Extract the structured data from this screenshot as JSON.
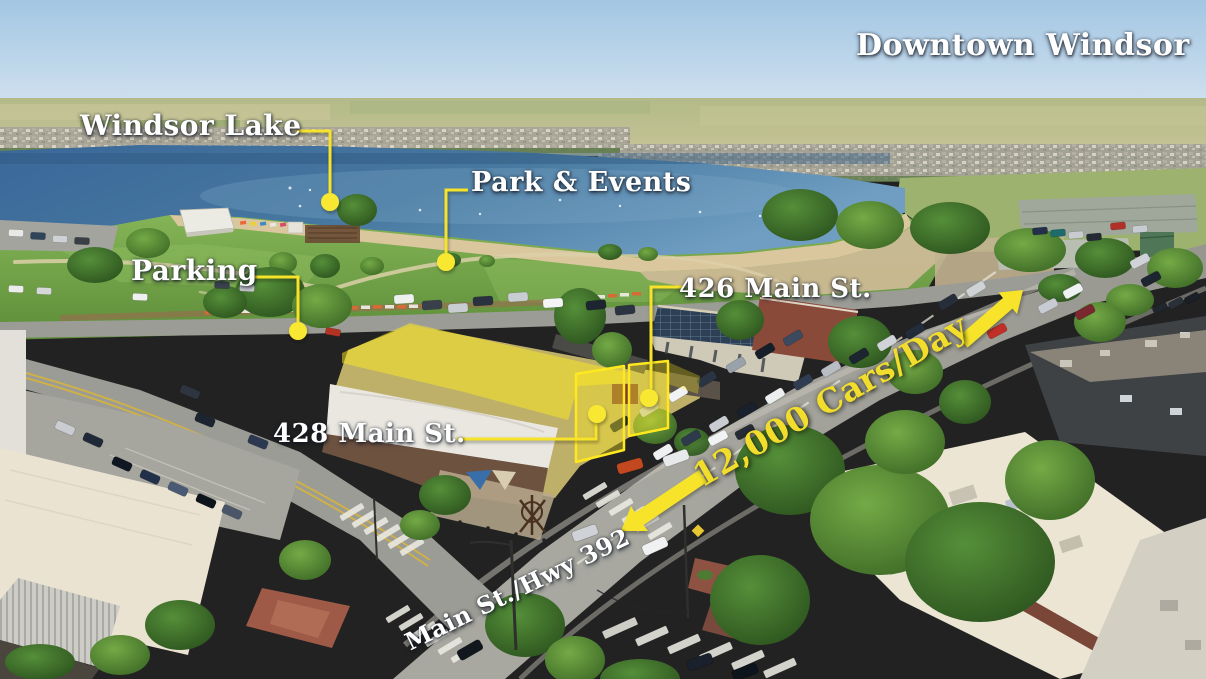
{
  "image": {
    "type": "annotated-aerial-photograph",
    "subject": "Downtown Windsor commercial property with Windsor Lake and Main Street"
  },
  "labels": {
    "downtown": "Downtown Windsor",
    "windsor_lake": "Windsor Lake",
    "park_events": "Park & Events",
    "parking": "Parking",
    "main_426": "426 Main St.",
    "main_428": "428 Main St.",
    "traffic": "12,000 Cars/Day",
    "highway": "Main St./Hwy 392"
  },
  "colors": {
    "annotation_yellow": "#f6e32b",
    "marker_dot_yellow": "#f8e832",
    "label_text": "#ffffff",
    "traffic_text": "#f2dd2d",
    "building_highlight_fill": "#fce921",
    "building_highlight_outline": "#ffe81f",
    "lake_blue": "#3e6e9e",
    "park_green": "#6da344"
  },
  "markers": [
    {
      "name": "windsor-lake-marker",
      "label": "Windsor Lake"
    },
    {
      "name": "park-events-marker",
      "label": "Park & Events"
    },
    {
      "name": "parking-marker",
      "label": "Parking"
    },
    {
      "name": "main-426-marker",
      "label": "426 Main St."
    },
    {
      "name": "main-428-marker",
      "label": "428 Main St."
    }
  ],
  "arrows": [
    {
      "name": "traffic-arrow-northeast",
      "direction": "up-right"
    },
    {
      "name": "traffic-arrow-southwest",
      "direction": "down-left"
    }
  ]
}
